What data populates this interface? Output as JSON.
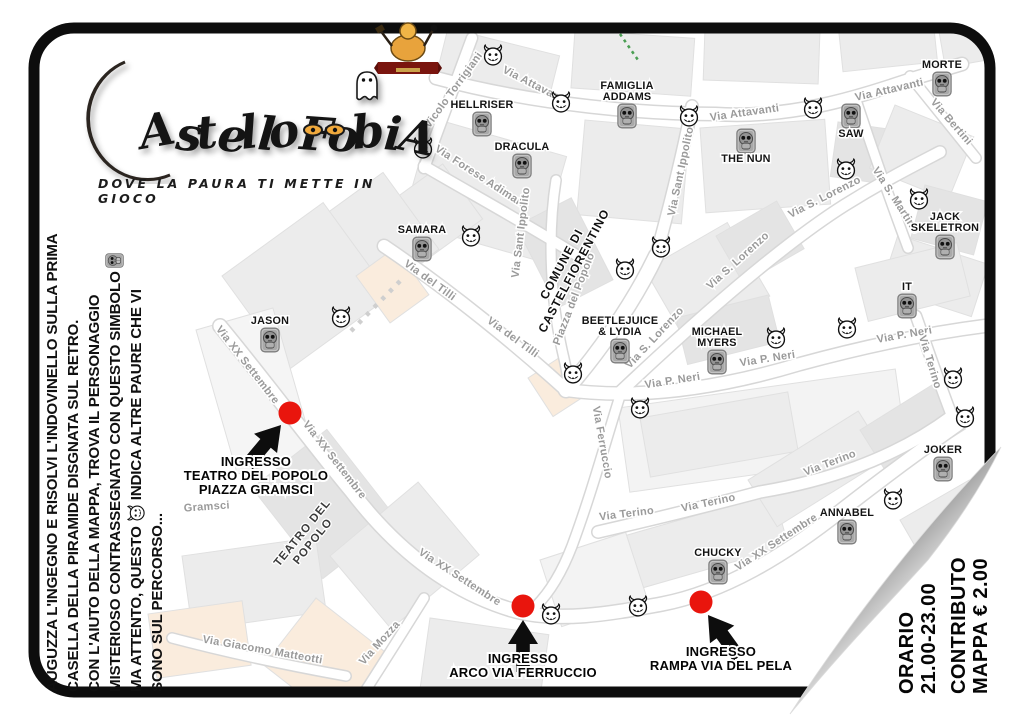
{
  "page": {
    "title_glyphs": "AstelloFobiA",
    "title_full": "CastelloFobia",
    "tagline": "DOVE LA PAURA TI METTE IN GIOCO"
  },
  "instructions": {
    "line1": "AUGUZZA L'INGEGNO E RISOLVI L'INDOVINELLO SULLA PRIMA",
    "line2": "CASELLA DELLA PIRAMIDE DISGNATA SUL RETRO.",
    "line3": "CON L'AIUTO DELLA MAPPA, TROVA IL PERSONAGGIO",
    "line4": "MISTERIOSO CONTRASSEGNATO CON QUESTO SIMBOLO",
    "line5a": "MA ATTENTO, QUESTO",
    "line5b": "INDICA ALTRE PAURE CHE VI",
    "line6": "SONO SUL PERCORSO..."
  },
  "info_panel": {
    "orario_label": "ORARIO",
    "orario_value": "21.00-23.00",
    "contributo_label": "CONTRIBUTO",
    "contributo_value": "MAPPA € 2.00"
  },
  "entrances": [
    {
      "lines": [
        "INGRESSO",
        "TEATRO DEL POPOLO",
        "PIAZZA GRAMSCI"
      ],
      "dot": [
        290,
        413
      ],
      "label": [
        256,
        466
      ],
      "arrow": {
        "tip": [
          281,
          425
        ],
        "rot": 40
      }
    },
    {
      "lines": [
        "INGRESSO",
        "ARCO VIA FERRUCCIO"
      ],
      "dot": [
        523,
        606
      ],
      "label": [
        523,
        663
      ],
      "arrow": {
        "tip": [
          523,
          620
        ],
        "rot": 0
      }
    },
    {
      "lines": [
        "INGRESSO",
        "RAMPA VIA DEL PELA"
      ],
      "dot": [
        701,
        602
      ],
      "label": [
        721,
        656
      ],
      "arrow": {
        "tip": [
          708,
          615
        ],
        "rot": -36
      }
    }
  ],
  "map": {
    "characters": [
      {
        "name": [
          "HELLRISER"
        ],
        "x": 482,
        "y": 124
      },
      {
        "name": [
          "DRACULA"
        ],
        "x": 522,
        "y": 166
      },
      {
        "name": [
          "FAMIGLIA",
          "ADDAMS"
        ],
        "x": 627,
        "y": 116
      },
      {
        "name": [
          "MORTE"
        ],
        "x": 942,
        "y": 84
      },
      {
        "name": [
          "SAW"
        ],
        "x": 851,
        "y": 116,
        "below": true
      },
      {
        "name": [
          "THE NUN"
        ],
        "x": 746,
        "y": 141,
        "below": true
      },
      {
        "name": [
          "JACK",
          "SKELETRON"
        ],
        "x": 945,
        "y": 247
      },
      {
        "name": [
          "SAMARA"
        ],
        "x": 422,
        "y": 249
      },
      {
        "name": [
          "JASON"
        ],
        "x": 270,
        "y": 340
      },
      {
        "name": [
          "BEETLEJUICE",
          "& LYDIA"
        ],
        "x": 620,
        "y": 351
      },
      {
        "name": [
          "MICHAEL",
          "MYERS"
        ],
        "x": 717,
        "y": 362
      },
      {
        "name": [
          "IT"
        ],
        "x": 907,
        "y": 306
      },
      {
        "name": [
          "JOKER"
        ],
        "x": 943,
        "y": 469
      },
      {
        "name": [
          "ANNABEL"
        ],
        "x": 847,
        "y": 532
      },
      {
        "name": [
          "CHUCKY"
        ],
        "x": 718,
        "y": 572
      }
    ],
    "devils": [
      [
        493,
        55
      ],
      [
        561,
        102
      ],
      [
        689,
        116
      ],
      [
        813,
        108
      ],
      [
        846,
        169
      ],
      [
        919,
        199
      ],
      [
        423,
        148
      ],
      [
        471,
        236
      ],
      [
        661,
        247
      ],
      [
        625,
        269
      ],
      [
        341,
        317
      ],
      [
        776,
        338
      ],
      [
        847,
        328
      ],
      [
        953,
        378
      ],
      [
        965,
        417
      ],
      [
        573,
        373
      ],
      [
        640,
        408
      ],
      [
        893,
        499
      ],
      [
        551,
        614
      ],
      [
        638,
        606
      ]
    ],
    "street_labels": [
      {
        "t": "Vicolo Torrigiani",
        "x": 456,
        "y": 92,
        "r": -54
      },
      {
        "t": "Via Attavanti",
        "x": 533,
        "y": 88,
        "r": 27
      },
      {
        "t": "Via Attavanti",
        "x": 745,
        "y": 116,
        "r": -8
      },
      {
        "t": "Via Attavanti",
        "x": 890,
        "y": 93,
        "r": -13
      },
      {
        "t": "Via Bertini",
        "x": 949,
        "y": 124,
        "r": 49
      },
      {
        "t": "Via Forese Adimari",
        "x": 478,
        "y": 179,
        "r": 33
      },
      {
        "t": "Via S. Martino",
        "x": 893,
        "y": 202,
        "r": 57
      },
      {
        "t": "Via S. Lorenzo",
        "x": 826,
        "y": 200,
        "r": -27
      },
      {
        "t": "Via Sant Ippolito",
        "x": 524,
        "y": 233,
        "r": -83
      },
      {
        "t": "Via Sant Ippolito",
        "x": 684,
        "y": 172,
        "r": -78
      },
      {
        "t": "Via del Tilli",
        "x": 428,
        "y": 283,
        "r": 36
      },
      {
        "t": "Via del Tilli",
        "x": 511,
        "y": 340,
        "r": 36
      },
      {
        "t": "Piazza del Popolo",
        "x": 577,
        "y": 300,
        "r": -69
      },
      {
        "t": "Via S. Lorenzo",
        "x": 740,
        "y": 263,
        "r": -42
      },
      {
        "t": "Via S. Lorenzo",
        "x": 657,
        "y": 340,
        "r": -47
      },
      {
        "t": "Via P. Neri",
        "x": 673,
        "y": 384,
        "r": -9
      },
      {
        "t": "Via P. Neri",
        "x": 768,
        "y": 362,
        "r": -9
      },
      {
        "t": "Via P. Neri",
        "x": 905,
        "y": 338,
        "r": -10
      },
      {
        "t": "Via Terino",
        "x": 927,
        "y": 363,
        "r": 73
      },
      {
        "t": "Via Terino",
        "x": 831,
        "y": 466,
        "r": -21
      },
      {
        "t": "Via Terino",
        "x": 709,
        "y": 506,
        "r": -12
      },
      {
        "t": "Via Terino",
        "x": 627,
        "y": 517,
        "r": -7
      },
      {
        "t": "Via Ferruccio",
        "x": 599,
        "y": 443,
        "r": 80
      },
      {
        "t": "Via XX Settembre",
        "x": 245,
        "y": 367,
        "r": 52
      },
      {
        "t": "Via XX Settembre",
        "x": 332,
        "y": 462,
        "r": 52
      },
      {
        "t": "Via XX Settembre",
        "x": 458,
        "y": 580,
        "r": 33
      },
      {
        "t": "Via XX Settembre",
        "x": 778,
        "y": 545,
        "r": -33
      },
      {
        "t": "Via Giacomo Matteotti",
        "x": 262,
        "y": 653,
        "r": 10
      },
      {
        "t": "Via Mozza",
        "x": 382,
        "y": 645,
        "r": -48
      },
      {
        "t": "Gramsci",
        "x": 207,
        "y": 510,
        "r": -4
      }
    ],
    "places": [
      {
        "lines": [
          "COMUNE DI",
          "CASTELFIORENTINO"
        ],
        "x": 565,
        "y": 266,
        "r": -62,
        "fs": 12,
        "color": "#111111",
        "ls": 1
      },
      {
        "lines": [
          "TEATRO DEL",
          "POPOLO"
        ],
        "x": 305,
        "y": 535,
        "r": -51,
        "fs": 11.5,
        "color": "#3c3c3c",
        "ls": 1
      }
    ],
    "colors": {
      "entrance_dot": "#e9150d",
      "street_label": "#9a9a9a",
      "building": "#ececec",
      "building_peach": "#faecdd",
      "moon": "#f1b440"
    }
  }
}
